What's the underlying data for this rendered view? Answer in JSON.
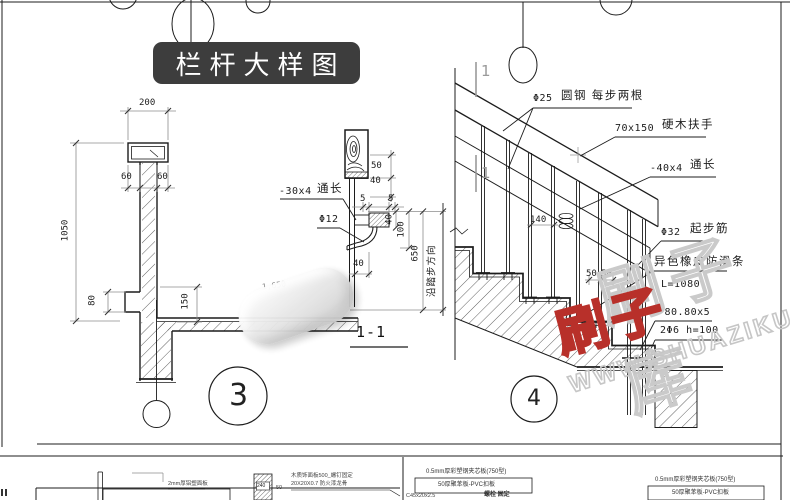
{
  "title": {
    "text": "栏杆大样图"
  },
  "detail3": {
    "bubble": "3",
    "dim_200": "200",
    "dim_60_left": "60",
    "dim_60_right": "60",
    "dim_1050": "1050",
    "dim_80": "80",
    "dim_150": "150",
    "dim_1650": "1,650"
  },
  "section_1_1": {
    "label": "1-1",
    "flat_bar": "-30x4",
    "flat_bar_note": "通长",
    "rebar": "Φ12",
    "dim_50": "50",
    "dim_40_top": "40",
    "dim_5_left": "5",
    "dim_5_right": "5",
    "dim_40_mid": "40",
    "dim_100": "100",
    "dim_650": "650",
    "dim_40_bottom": "40",
    "direction_note": "沿踏步方向"
  },
  "detail4": {
    "bubble": "4",
    "section_mark_top": "1",
    "section_mark_bottom": "1",
    "ann_rod_size": "Φ25",
    "ann_rod_text": "圆钢 每步两根",
    "ann_rail_size": "70x150",
    "ann_rail_text": "硬木扶手",
    "ann_bar_size": "-40x4",
    "ann_bar_text": "通长",
    "ann_start_size": "Φ32",
    "ann_start_text": "起步筋",
    "ann_strip": "异色橡皮防滑条",
    "ann_strip_len": "L=1080",
    "ann_plate": "-80.80x5",
    "ann_anchor": "2Φ6 h=100",
    "dim_140": "140",
    "dim_50_a": "50",
    "dim_50_b": "50"
  },
  "bottom_strip": {
    "left_note_1": "2mm厚铝塑面板",
    "left_note_2": "木质饰面板500_螺钉固定",
    "left_note_3": "20X20X0.7 防火漆龙骨",
    "left_col_label": "240",
    "left_dim": "50",
    "right_note_1": "0.5mm厚彩塑钢夹芯板(750型)",
    "right_note_2": "50厚聚苯板-PVC扣板",
    "right_note_3a": "C45x20x2.5",
    "right_note_3b": "螺栓 固定",
    "right_note_4": "0.5mm厚彩塑钢夹芯板(750型)",
    "right_note_5": "50厚聚苯板-PVC扣板"
  },
  "watermark": {
    "site": "WWW.SHUAZIKU.COM",
    "logo_grey": "刷子库",
    "logo_red": "刷子"
  },
  "colors": {
    "badge_bg": "#3d3d3d",
    "badge_text": "#ffffff",
    "line": "#1c1c1c",
    "dim": "#8c8c8c",
    "watermark_grey": "#cacaca",
    "watermark_red": "#b8302a"
  }
}
